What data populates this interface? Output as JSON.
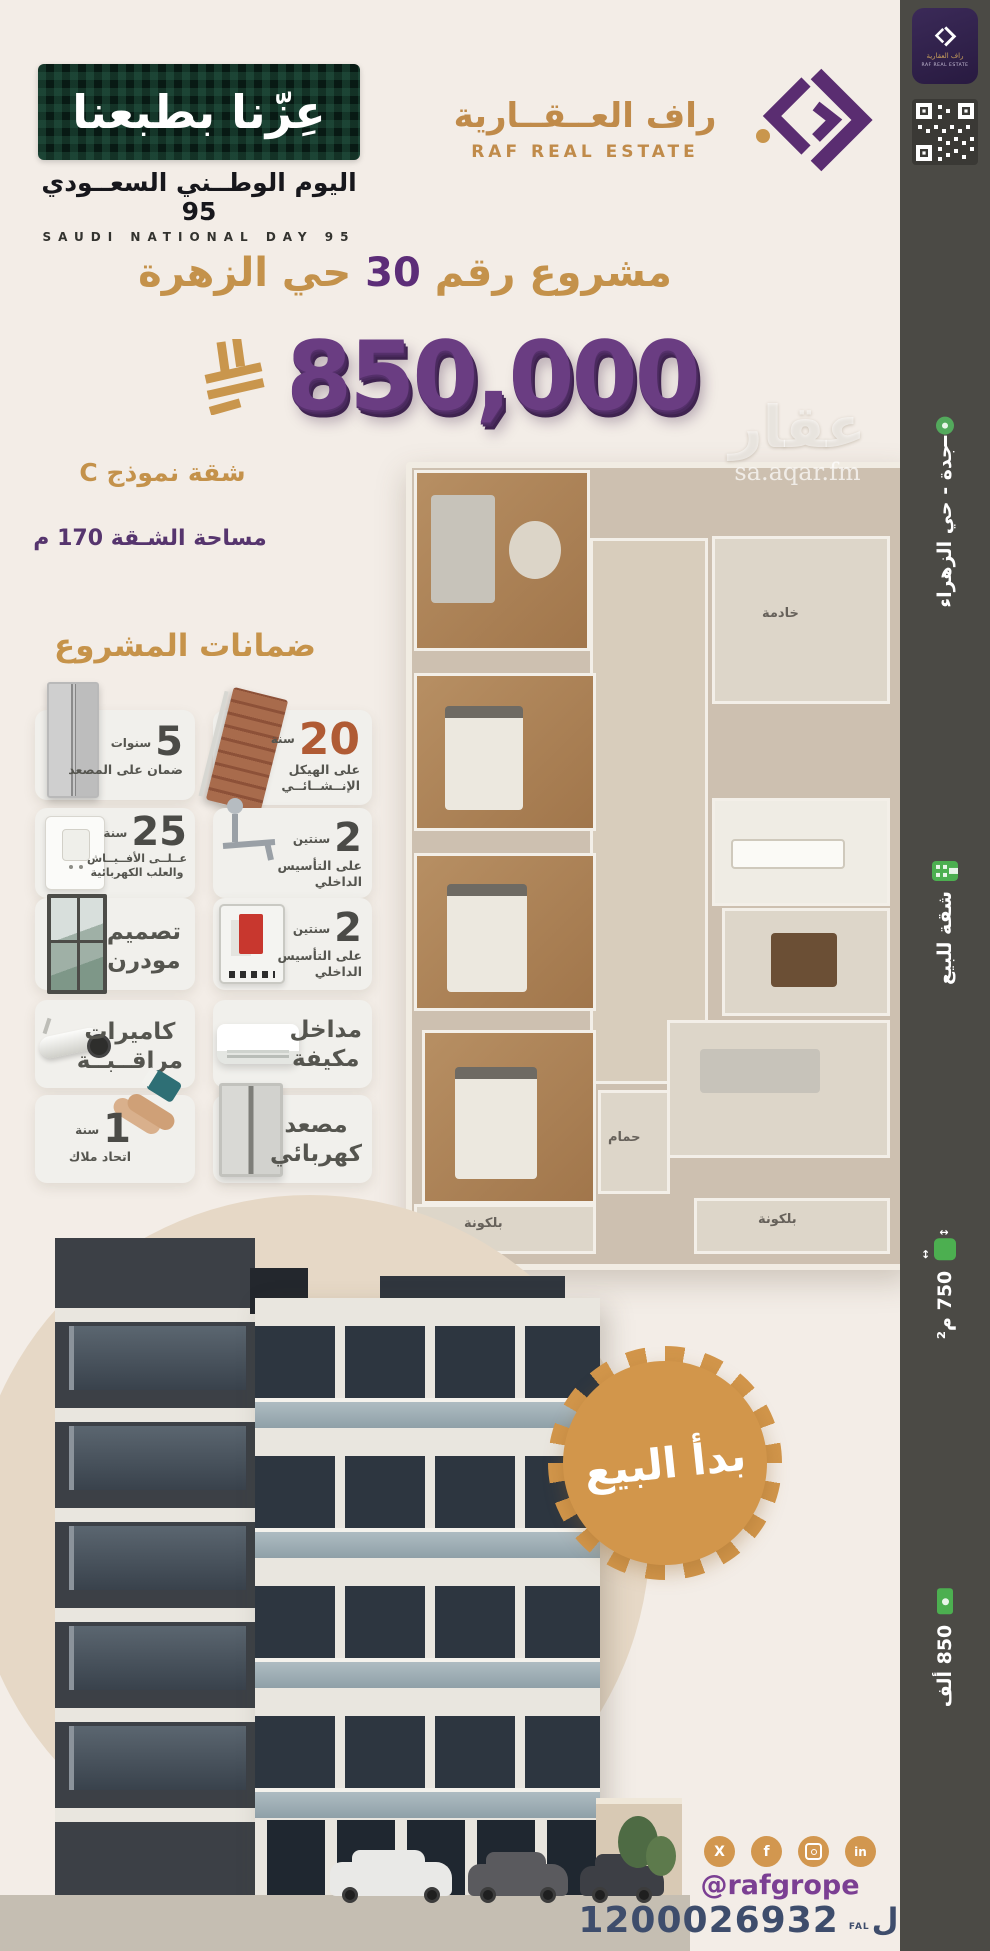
{
  "national_day": {
    "slogan": "عِزّنا بطبعنا",
    "title_ar": "اليوم الوطــني السعــودي 95",
    "title_en": "SAUDI NATIONAL DAY 95"
  },
  "brand": {
    "name_ar": "راف العــقــارية",
    "name_en": "RAF REAL ESTATE"
  },
  "corner_badge": {
    "name_ar": "راف العقارية",
    "name_en": "RAF REAL ESTATE"
  },
  "project": {
    "title_pre": "مشروع رقم",
    "title_num": "30",
    "title_post": "حي الزهرة",
    "price": "850,000",
    "model": "شقة نموذج C",
    "area": "مساحة الشـقة 170 م"
  },
  "guarantees": {
    "heading": "ضمانات المشروع",
    "items": [
      {
        "value": "5",
        "unit": "سنوات",
        "line1": "ضمان على المصعد",
        "line2": ""
      },
      {
        "value": "20",
        "unit": "سنة",
        "line1": "على الهيكل",
        "line2": "الإنــشــائــي"
      },
      {
        "value": "25",
        "unit": "سنة",
        "line1": "عــلــى الأفــيــاش",
        "line2": "والعلب الكهربائية"
      },
      {
        "value": "2",
        "unit": "سنتين",
        "line1": "على التأسيس",
        "line2": "الداخلي"
      },
      {
        "value": "",
        "unit": "",
        "line1": "تصميم",
        "line2": "مودرن"
      },
      {
        "value": "2",
        "unit": "سنتين",
        "line1": "على التأسيس",
        "line2": "الداخلي"
      },
      {
        "value": "",
        "unit": "",
        "line1": "كاميرات",
        "line2": "مراقــبــة"
      },
      {
        "value": "",
        "unit": "",
        "line1": "مداخل",
        "line2": "مكيفة"
      },
      {
        "value": "1",
        "unit": "سنة",
        "line1": "اتحاد ملاك",
        "line2": ""
      },
      {
        "value": "",
        "unit": "",
        "line1": "مصعد",
        "line2": "كهربائي"
      }
    ]
  },
  "floor_plan": {
    "labels": [
      "خادمة",
      "حمام",
      "بلكونة",
      "بلكونة"
    ]
  },
  "watermark": {
    "brand": "عقار",
    "domain": "sa.aqar.fm"
  },
  "sidebar": {
    "location": "جدة - حي الزهراء",
    "listing_type": "شقة للبيع",
    "area": "750 م²",
    "price_short": "850 ألف"
  },
  "sale_banner": "بدأ البيع",
  "footer": {
    "handle": "@rafgrope",
    "phone": "1200026932",
    "fal_ar": "فــال",
    "fal_en": "FAL",
    "social": {
      "x": "X",
      "facebook": "f",
      "linkedin": "in"
    }
  },
  "colors": {
    "gold": "#c6934a",
    "purple": "#6a3d82",
    "brand_purple": "#5a2d71",
    "navy": "#3e4d6c",
    "sidebar": "#4b4a45",
    "green": "#4caf50"
  }
}
